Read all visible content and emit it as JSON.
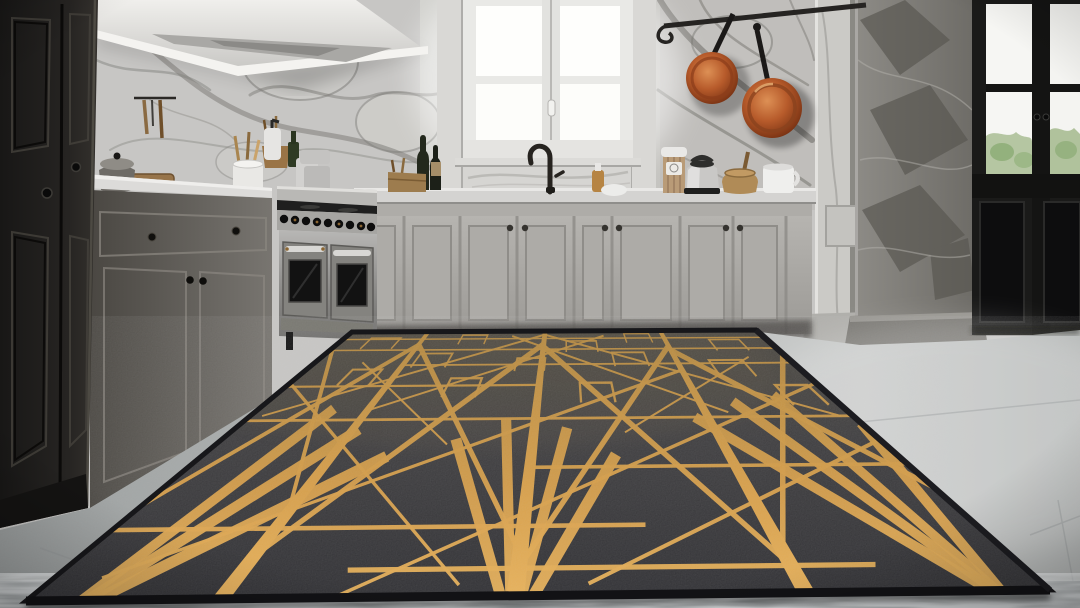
{
  "scene": {
    "type": "photograph",
    "setting": "luxury kitchen interior",
    "description": "Modern kitchen with gray-veined marble walls, gray paneled cabinetry, a stainless steel range under a white canopy hood, a bright white casement window over a black gooseneck faucet, copper pans hanging on a rail, a black French door with greenery visible, and a large black area rug with a gold Art Deco geometric line pattern lying on a light gray stone floor."
  },
  "objects": [
    "tall-black-cabinet",
    "range-hood",
    "marble-wall",
    "utensil-rail",
    "casserole-pot",
    "cutting-board",
    "stock-pot",
    "utensil-crock",
    "soap-dispenser",
    "green-bottle",
    "gray-canisters",
    "lower-cabinets-left",
    "gas-range",
    "wine-bottles",
    "wooden-crate",
    "casement-window",
    "kitchen-faucet",
    "oil-bottle",
    "white-bowl",
    "back-cabinet-run",
    "storage-canister",
    "electric-kettle",
    "wooden-jar",
    "white-mug",
    "pot-rail",
    "copper-pan-small",
    "copper-pan-large",
    "marble-pilaster",
    "dark-marble-column",
    "french-door",
    "stone-floor",
    "area-rug"
  ],
  "palette": {
    "marble_light": "#cbcac7",
    "marble_vein": "#7f7e7a",
    "marble_dark_column": "#7d7b76",
    "cabinet_gray": "#b3b1ad",
    "cabinet_black": "#23211f",
    "countertop": "#d6d5d2",
    "stainless_steel": "#a3a2a0",
    "copper": "#b75b2b",
    "window_light": "#fdfdfb",
    "door_black": "#161615",
    "greenery": "#a8bd92",
    "floor_light": "#bcbfbe",
    "floor_foreground": "#7e8385"
  },
  "rug": {
    "corners": {
      "tl": [
        352,
        332
      ],
      "tr": [
        756,
        330
      ],
      "br": [
        1050,
        590
      ],
      "bl": [
        26,
        601
      ]
    },
    "persp": {
      "num": 2.2,
      "den": 1.2
    },
    "colors": {
      "gold_top": "#b4873c",
      "gold_mid": "#d79d45",
      "gold_bottom": "#ecb459",
      "base_top": "#4b473f",
      "base_mid": "#3a393b",
      "base_bottom": "#2b2b2f",
      "border": "#17171a"
    },
    "band_width": 9,
    "thin_width": 2.6,
    "fan_width": 6.5,
    "bands": [
      0.19,
      0.478,
      0.762
    ],
    "horizontals": [
      {
        "d": 0.06
      },
      {
        "d": 0.14
      },
      {
        "d": 0.24,
        "u1": 0.19,
        "u2": 1.0
      },
      {
        "d": 0.36,
        "u1": 0.0,
        "u2": 0.478
      },
      {
        "d": 0.52
      },
      {
        "d": 0.7,
        "u1": 0.478,
        "u2": 1.0
      },
      {
        "d": 0.86,
        "u1": 0.0,
        "u2": 0.62
      },
      {
        "d": 0.95,
        "u1": 0.3,
        "u2": 0.85
      }
    ],
    "diagonals": [
      [
        0.0,
        0.8,
        0.19,
        0.1,
        4.0
      ],
      [
        0.0,
        0.12,
        0.19,
        0.82,
        4.0
      ],
      [
        0.19,
        0.92,
        0.478,
        0.1,
        5.0
      ],
      [
        0.19,
        0.1,
        0.478,
        0.92,
        5.0
      ],
      [
        0.478,
        0.95,
        0.762,
        0.12,
        5.0
      ],
      [
        0.478,
        0.12,
        0.762,
        0.95,
        5.0
      ],
      [
        0.762,
        0.92,
        1.0,
        0.18,
        5.0
      ],
      [
        0.762,
        0.15,
        1.01,
        0.8,
        5.0
      ],
      [
        0.02,
        0.5,
        0.478,
        0.03,
        2.6
      ],
      [
        0.478,
        0.03,
        0.98,
        0.52,
        2.6
      ],
      [
        0.05,
        0.96,
        0.762,
        0.28,
        2.6
      ],
      [
        0.3,
        1.0,
        1.0,
        0.36,
        2.6
      ],
      [
        0.0,
        0.34,
        0.42,
        0.98,
        2.6
      ],
      [
        0.55,
        0.98,
        1.02,
        0.6,
        2.6
      ],
      [
        0.19,
        0.48,
        0.62,
        0.04,
        2.6
      ],
      [
        0.4,
        0.04,
        0.8,
        0.5,
        2.6
      ],
      [
        0.1,
        0.22,
        0.35,
        0.62,
        2.2
      ],
      [
        0.62,
        0.58,
        0.92,
        0.2,
        2.2
      ]
    ],
    "fans": [
      {
        "u": 0.478,
        "d": 1.06,
        "to": [
          [
            0.36,
            0.6
          ],
          [
            0.43,
            0.52
          ],
          [
            0.53,
            0.56
          ],
          [
            0.6,
            0.66
          ]
        ]
      },
      {
        "u": 0.95,
        "d": 1.02,
        "to": [
          [
            0.74,
            0.52
          ],
          [
            0.82,
            0.45
          ],
          [
            0.9,
            0.42
          ],
          [
            1.0,
            0.55
          ]
        ]
      },
      {
        "u": 0.05,
        "d": 1.03,
        "to": [
          [
            0.13,
            0.47
          ],
          [
            0.2,
            0.56
          ],
          [
            0.27,
            0.66
          ]
        ]
      }
    ],
    "staples": [
      [
        0.1,
        0.09,
        0.035,
        0.04
      ],
      [
        0.31,
        0.065,
        0.03,
        0.035
      ],
      [
        0.565,
        0.12,
        0.035,
        0.04
      ],
      [
        0.7,
        0.06,
        0.03,
        0.035
      ],
      [
        0.9,
        0.115,
        0.035,
        0.04
      ],
      [
        0.245,
        0.21,
        0.035,
        0.045
      ],
      [
        0.455,
        0.24,
        0.03,
        0.04
      ],
      [
        0.665,
        0.21,
        0.035,
        0.045
      ],
      [
        0.865,
        0.27,
        0.035,
        0.05
      ],
      [
        0.335,
        0.37,
        0.03,
        0.05
      ],
      [
        0.585,
        0.4,
        0.03,
        0.05
      ],
      [
        0.125,
        0.31,
        0.03,
        0.045
      ],
      [
        0.95,
        0.42,
        0.03,
        0.05
      ]
    ]
  }
}
